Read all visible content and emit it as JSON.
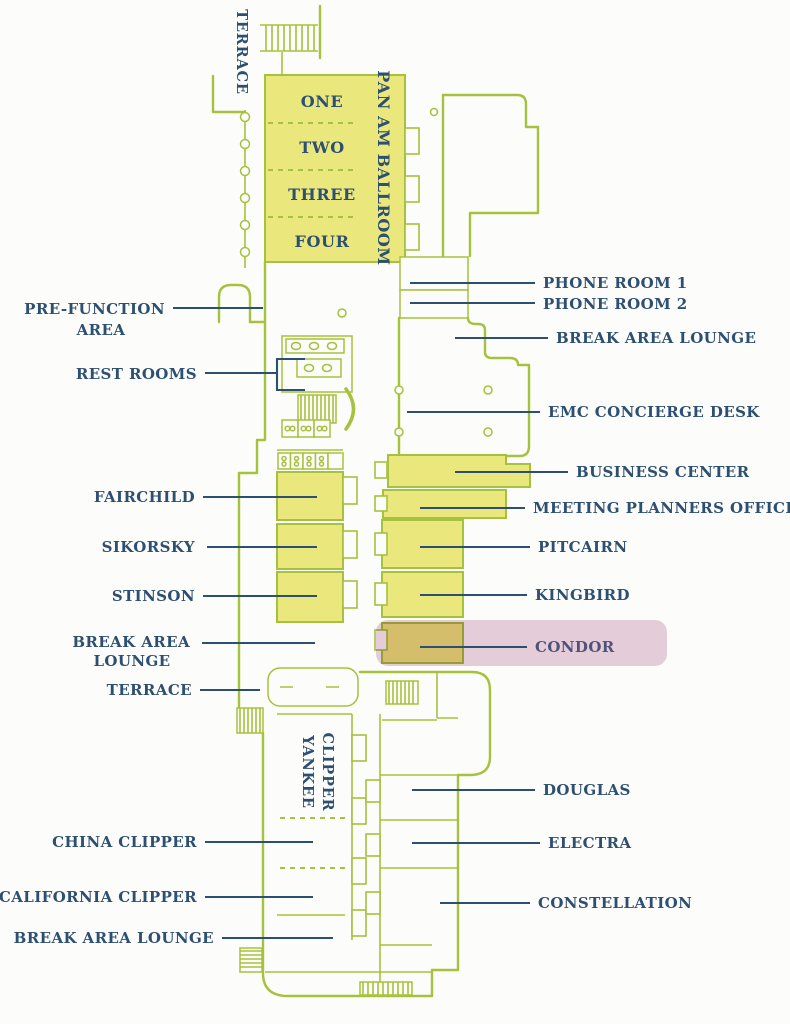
{
  "title": "Conference center floor plan",
  "colors": {
    "wall_green": "#a6c13d",
    "room_fill_yellow": "#eae87c",
    "label_navy": "#2d4f71",
    "highlight_pink": "#e7d0dc",
    "condor_label": "#51527c",
    "background": "#fcfcfb"
  },
  "ballroom": {
    "title": "PAN AM BALLROOM",
    "sections": [
      "ONE",
      "TWO",
      "THREE",
      "FOUR"
    ]
  },
  "vertical_labels": {
    "terrace_top": "TERRACE",
    "yankee": "YANKEE",
    "clipper": "CLIPPER"
  },
  "left_labels": {
    "prefunction_line1": "PRE-FUNCTION",
    "prefunction_line2": "AREA",
    "restrooms": "REST ROOMS",
    "fairchild": "FAIRCHILD",
    "sikorsky": "SIKORSKY",
    "stinson": "STINSON",
    "break_area_line1": "BREAK AREA",
    "break_area_line2": "LOUNGE",
    "terrace": "TERRACE",
    "china_clipper": "CHINA CLIPPER",
    "california_clipper": "CALIFORNIA CLIPPER",
    "break_area_lounge_bottom": "BREAK AREA LOUNGE"
  },
  "right_labels": {
    "phone_room_1": "PHONE ROOM 1",
    "phone_room_2": "PHONE ROOM 2",
    "break_area_lounge": "BREAK AREA LOUNGE",
    "emc_concierge_desk": "EMC CONCIERGE DESK",
    "business_center": "BUSINESS CENTER",
    "meeting_planners_office": "MEETING PLANNERS OFFICE",
    "pitcairn": "PITCAIRN",
    "kingbird": "KINGBIRD",
    "condor": "CONDOR",
    "douglas": "DOUGLAS",
    "electra": "ELECTRA",
    "constellation": "CONSTELLATION"
  },
  "highlight": {
    "room": "CONDOR",
    "style": "pink rounded rectangle over room and label"
  }
}
